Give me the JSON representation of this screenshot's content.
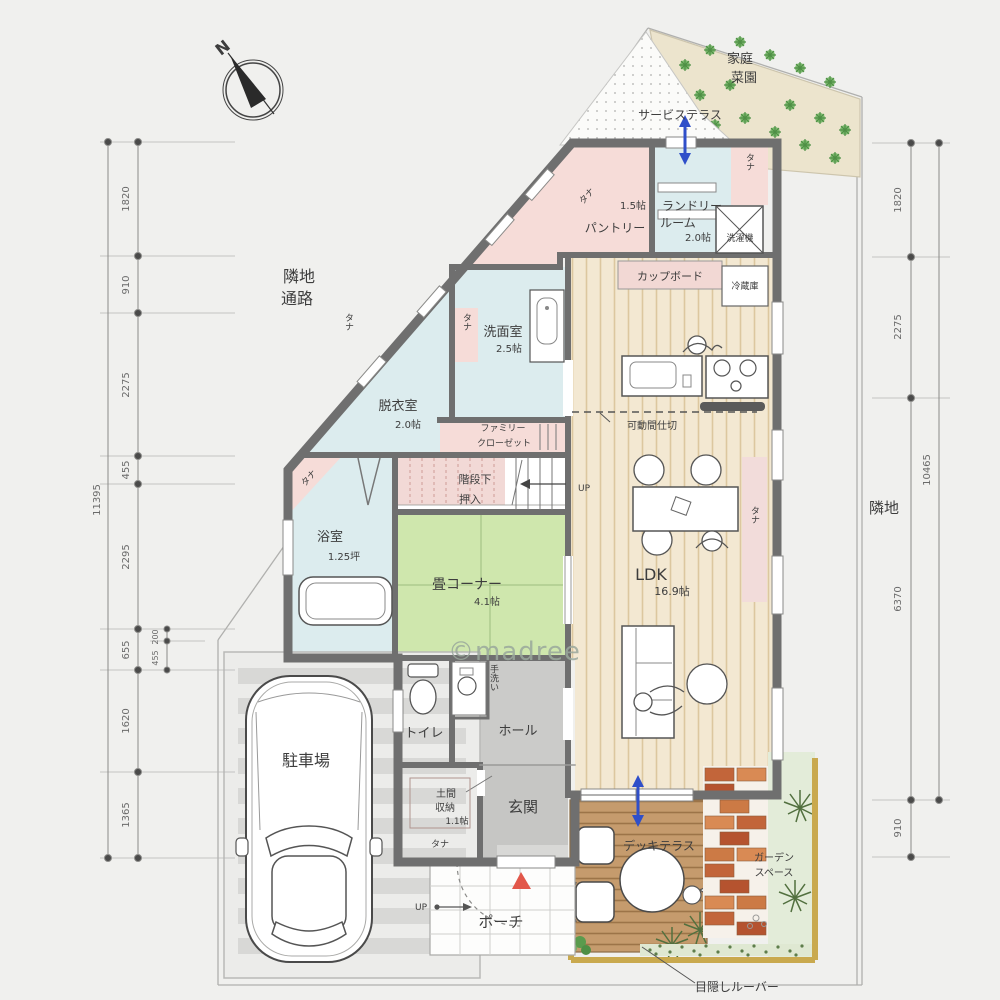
{
  "watermark": "©madree",
  "compass": {
    "north": "N"
  },
  "site": {
    "neighbor_passage": [
      "隣地",
      "通路"
    ],
    "neighbor_right": "隣地",
    "kitchen_garden": [
      "家庭",
      "菜園"
    ],
    "service_terrace": "サービステラス",
    "garden_space": [
      "ガーデン",
      "スペース"
    ],
    "privacy_louver": "目隠しルーバー",
    "parking": "駐車場",
    "porch": "ポーチ",
    "deck_terrace": "デッキテラス"
  },
  "rooms": {
    "pantry": {
      "name": "パントリー",
      "size": "1.5帖"
    },
    "laundry": {
      "name1": "ランドリー",
      "name2": "ルーム",
      "size": "2.0帖"
    },
    "washer": "洗濯機",
    "cupboard": "カップボード",
    "fridge": "冷蔵庫",
    "washroom": {
      "name": "洗面室",
      "size": "2.5帖"
    },
    "dressing": {
      "name": "脱衣室",
      "size": "2.0帖"
    },
    "family_closet": [
      "ファミリー",
      "クローゼット"
    ],
    "under_stairs": [
      "階段下",
      "押入"
    ],
    "bath": {
      "name": "浴室",
      "size": "1.25坪"
    },
    "tatami": {
      "name": "畳コーナー",
      "size": "4.1帖"
    },
    "ldk": {
      "name": "LDK",
      "size": "16.9帖"
    },
    "partition": "可動間仕切",
    "toilet": "トイレ",
    "handwash": "手洗い",
    "hall": "ホール",
    "genkan": "玄関",
    "doma": {
      "name1": "土間",
      "name2": "収納",
      "size": "1.1帖"
    },
    "shelf": "タナ",
    "up": "UP"
  },
  "dimensions": {
    "left": [
      "1820",
      "910",
      "2275",
      "455",
      "2295",
      "655",
      "1620",
      "1365"
    ],
    "left_total": "11395",
    "left_inner": [
      "200",
      "455"
    ],
    "right": [
      "1820",
      "2275",
      "6370",
      "910"
    ],
    "right_total": "10465"
  },
  "colors": {
    "wall": "#6f6f6f",
    "room_pink": "#f6dcd8",
    "room_blue": "#dcecee",
    "tatami_green": "#cfe7ad",
    "wood_floor": "#f3e8d2",
    "hall_gray": "#cbcbc9",
    "deck_brown": "#c59b6d",
    "brick_orange": "#c2653a",
    "garden_green": "#e3ecd9",
    "arrow_blue": "#2f4fc9",
    "entrance_red": "#e2574a",
    "louver_tan": "#c9a94e",
    "dimension_gray": "#6a6a6a",
    "watermark_gray": "#9aa89c"
  }
}
